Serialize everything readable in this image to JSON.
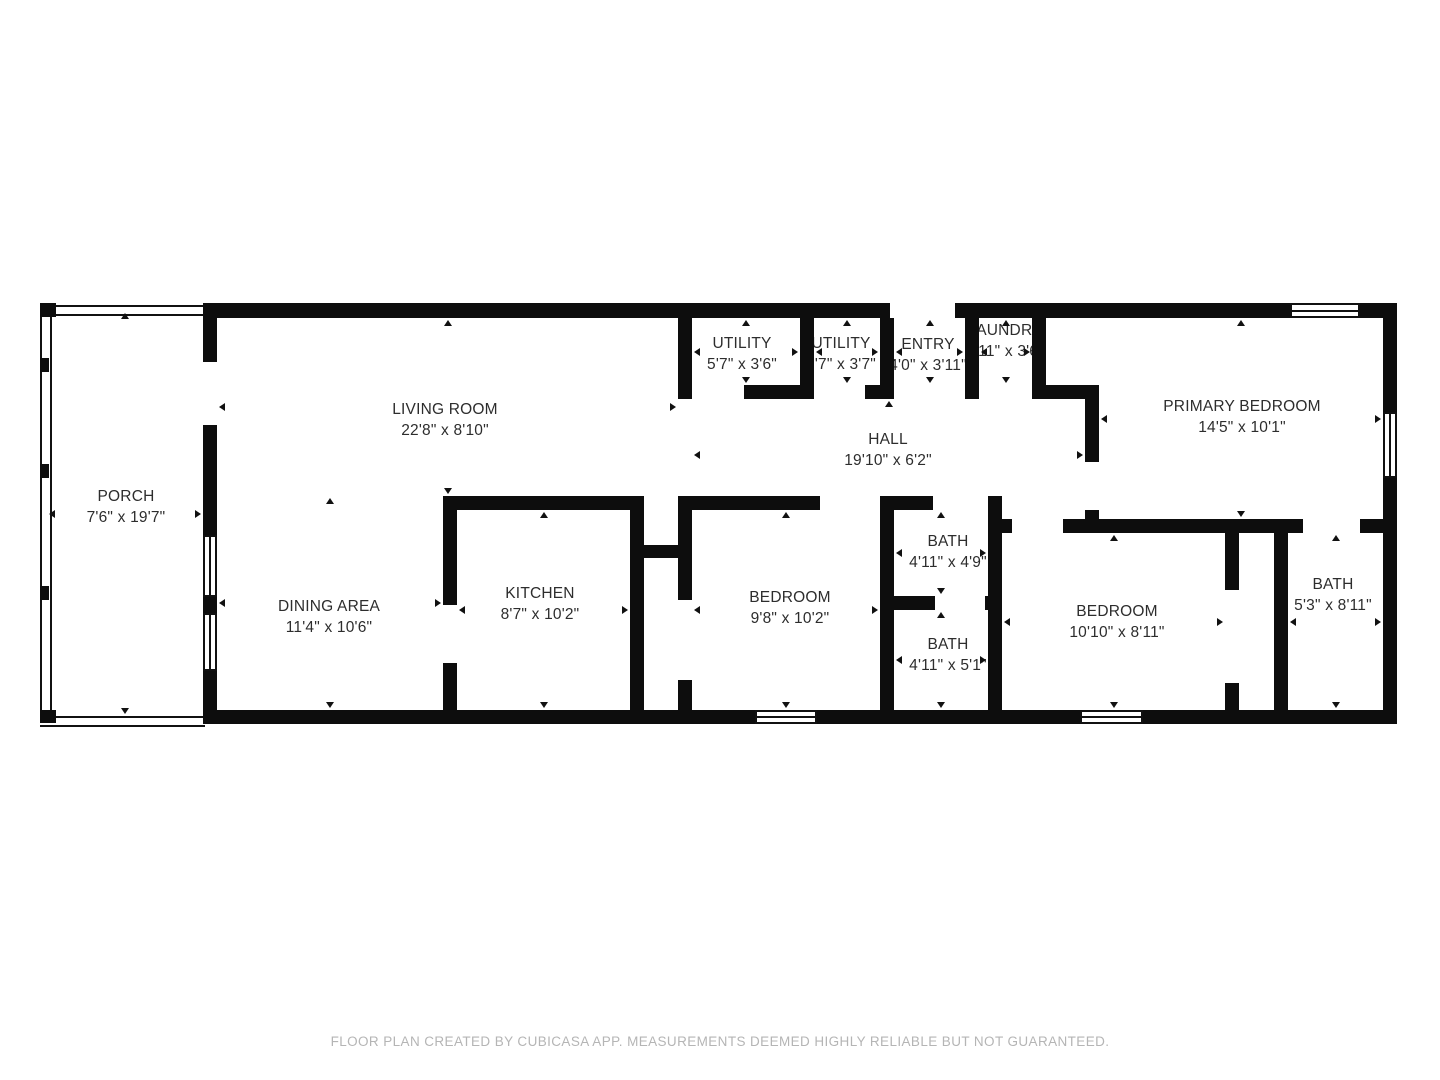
{
  "footer": {
    "text": "FLOOR PLAN CREATED BY CUBICASA APP. MEASUREMENTS DEEMED HIGHLY RELIABLE BUT NOT GUARANTEED."
  },
  "colors": {
    "wall": "#0d0d0d",
    "label_text": "#2d2d2d",
    "footer_text": "#b5b5b5",
    "background": "#ffffff"
  },
  "floorplan": {
    "rooms": [
      {
        "id": "porch",
        "name": "PORCH",
        "dims": "7'6\" x 19'7\"",
        "label": {
          "x": 126,
          "y": 507
        },
        "rect": [
          47,
          311,
          156,
          405
        ]
      },
      {
        "id": "living-room",
        "name": "LIVING ROOM",
        "dims": "22'8\" x 8'10\"",
        "label": {
          "x": 445,
          "y": 420
        },
        "rect": [
          217,
          318,
          461,
          178
        ]
      },
      {
        "id": "dining-area",
        "name": "DINING AREA",
        "dims": "11'4\" x 10'6\"",
        "label": {
          "x": 329,
          "y": 617
        },
        "rect": [
          217,
          496,
          226,
          214
        ]
      },
      {
        "id": "kitchen",
        "name": "KITCHEN",
        "dims": "8'7\" x 10'2\"",
        "label": {
          "x": 540,
          "y": 604
        },
        "rect": [
          457,
          510,
          173,
          200
        ]
      },
      {
        "id": "utility-1",
        "name": "UTILITY",
        "dims": "5'7\" x 3'6\"",
        "label": {
          "x": 742,
          "y": 354
        },
        "rect": [
          692,
          318,
          108,
          67
        ]
      },
      {
        "id": "utility-2",
        "name": "UTILITY",
        "dims": "3'7\" x 3'7\"",
        "label": {
          "x": 841,
          "y": 354
        },
        "rect": [
          814,
          318,
          66,
          67
        ]
      },
      {
        "id": "entry",
        "name": "ENTRY",
        "dims": "4'0\" x 3'11\"",
        "label": {
          "x": 928,
          "y": 355
        },
        "rect": [
          894,
          318,
          71,
          67
        ]
      },
      {
        "id": "laundry",
        "name": "LAUNDRY",
        "dims": "2'11\" x 3'6\"",
        "label": {
          "x": 1005,
          "y": 341
        },
        "rect": [
          979,
          318,
          53,
          67
        ]
      },
      {
        "id": "hall",
        "name": "HALL",
        "dims": "19'10\" x 6'2\"",
        "label": {
          "x": 888,
          "y": 450
        },
        "rect": [
          692,
          399,
          393,
          111
        ]
      },
      {
        "id": "primary-bedroom",
        "name": "PRIMARY BEDROOM",
        "dims": "14'5\" x 10'1\"",
        "label": {
          "x": 1242,
          "y": 417
        },
        "rect": [
          1099,
          318,
          284,
          201
        ]
      },
      {
        "id": "bath-1",
        "name": "BATH",
        "dims": "4'11\" x 4'9\"",
        "label": {
          "x": 948,
          "y": 552
        },
        "rect": [
          894,
          510,
          94,
          86
        ]
      },
      {
        "id": "bath-2",
        "name": "BATH",
        "dims": "4'11\" x 5'1\"",
        "label": {
          "x": 948,
          "y": 655
        },
        "rect": [
          894,
          610,
          94,
          100
        ]
      },
      {
        "id": "bedroom-1",
        "name": "BEDROOM",
        "dims": "9'8\" x 10'2\"",
        "label": {
          "x": 790,
          "y": 608
        },
        "rect": [
          692,
          510,
          188,
          200
        ]
      },
      {
        "id": "bedroom-2",
        "name": "BEDROOM",
        "dims": "10'10\" x 8'11\"",
        "label": {
          "x": 1117,
          "y": 622
        },
        "rect": [
          1002,
          533,
          223,
          177
        ]
      },
      {
        "id": "bath-3",
        "name": "BATH",
        "dims": "5'3\" x 8'11\"",
        "label": {
          "x": 1333,
          "y": 595
        },
        "rect": [
          1288,
          533,
          95,
          177
        ]
      }
    ],
    "walls": [
      [
        205,
        303,
        685,
        15
      ],
      [
        955,
        303,
        335,
        15
      ],
      [
        1360,
        303,
        37,
        15
      ],
      [
        205,
        710,
        550,
        14
      ],
      [
        817,
        710,
        263,
        14
      ],
      [
        1143,
        710,
        254,
        14
      ],
      [
        744,
        385,
        70,
        14
      ],
      [
        865,
        385,
        29,
        14
      ],
      [
        1032,
        385,
        67,
        14
      ],
      [
        443,
        496,
        201,
        14
      ],
      [
        678,
        496,
        142,
        14
      ],
      [
        894,
        496,
        39,
        14
      ],
      [
        630,
        545,
        62,
        13
      ],
      [
        880,
        596,
        55,
        14
      ],
      [
        985,
        596,
        17,
        14
      ],
      [
        1002,
        519,
        10,
        14
      ],
      [
        1063,
        519,
        240,
        14
      ],
      [
        1360,
        519,
        37,
        14
      ],
      [
        203,
        303,
        14,
        59
      ],
      [
        203,
        425,
        14,
        110
      ],
      [
        203,
        597,
        14,
        16
      ],
      [
        203,
        671,
        14,
        53
      ],
      [
        443,
        496,
        14,
        109
      ],
      [
        443,
        663,
        14,
        47
      ],
      [
        630,
        496,
        14,
        214
      ],
      [
        678,
        318,
        14,
        81
      ],
      [
        678,
        496,
        14,
        104
      ],
      [
        678,
        680,
        14,
        30
      ],
      [
        800,
        318,
        14,
        81
      ],
      [
        880,
        318,
        14,
        81
      ],
      [
        880,
        496,
        14,
        214
      ],
      [
        965,
        318,
        14,
        81
      ],
      [
        1032,
        318,
        14,
        81
      ],
      [
        1085,
        385,
        14,
        77
      ],
      [
        1085,
        510,
        14,
        23
      ],
      [
        988,
        496,
        14,
        214
      ],
      [
        1225,
        519,
        14,
        71
      ],
      [
        1225,
        683,
        14,
        27
      ],
      [
        1274,
        519,
        14,
        191
      ],
      [
        1383,
        303,
        14,
        109
      ],
      [
        1383,
        478,
        14,
        246
      ]
    ],
    "thin_walls": [
      {
        "x": 40,
        "y": 305,
        "w": 8,
        "h": 417,
        "orient": "v"
      },
      {
        "x": 40,
        "y": 305,
        "w": 165,
        "h": 7,
        "orient": "h"
      },
      {
        "x": 40,
        "y": 716,
        "w": 165,
        "h": 7,
        "orient": "h"
      }
    ],
    "posts": [
      [
        40,
        303,
        16,
        14
      ],
      [
        40,
        358,
        9,
        14
      ],
      [
        40,
        464,
        9,
        14
      ],
      [
        40,
        586,
        9,
        14
      ],
      [
        40,
        710,
        16,
        13
      ]
    ],
    "windows": [
      {
        "x": 1290,
        "y": 303,
        "w": 70,
        "h": 15,
        "orient": "h"
      },
      {
        "x": 1383,
        "y": 412,
        "w": 14,
        "h": 66,
        "orient": "v"
      },
      {
        "x": 755,
        "y": 710,
        "w": 62,
        "h": 14,
        "orient": "h"
      },
      {
        "x": 1080,
        "y": 710,
        "w": 63,
        "h": 14,
        "orient": "h"
      },
      {
        "x": 203,
        "y": 535,
        "w": 14,
        "h": 62,
        "orient": "v"
      },
      {
        "x": 203,
        "y": 613,
        "w": 14,
        "h": 58,
        "orient": "v"
      }
    ]
  }
}
